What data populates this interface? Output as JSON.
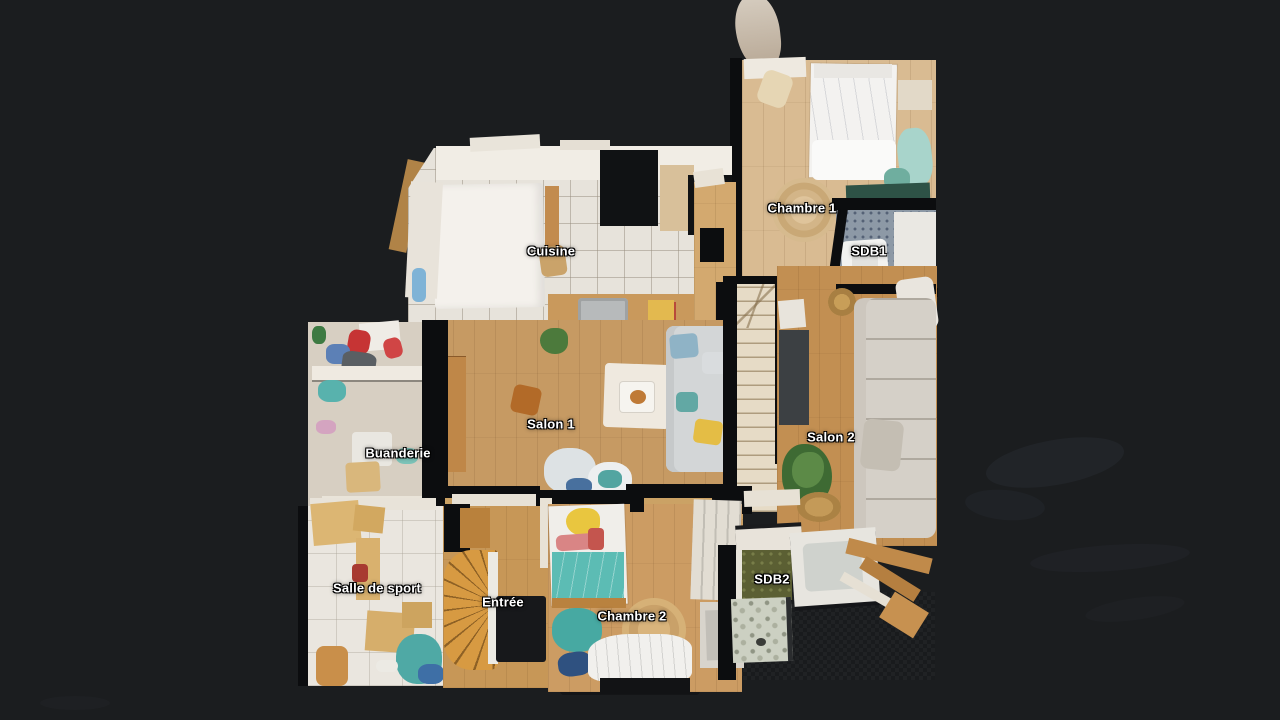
{
  "scene": {
    "type": "floorplan-top-down-scan",
    "description": "3D dollhouse floor plan view of an apartment on a dark viewer background"
  },
  "palette": {
    "bg": "#1b1d1f",
    "wall": "#0c0d0f",
    "label_text": "#ffffff",
    "wood1": "#d9bb92",
    "wood2": "#c69a63",
    "wood3": "#c28f52",
    "wood4": "#c79757",
    "wood5": "#cc9c63",
    "hall_wood": "#cba265",
    "tile_kitchen": "#e7e3db",
    "floor_sport": "#eae6df",
    "floor_buanderie": "#d7cfc2",
    "stairs": "#e6dbc6",
    "stairs_spiral": "#d79a42",
    "tile_sdb1": "#8d99a6",
    "green_sdb2": "#5b5f33",
    "shower": "#ccd0c2"
  },
  "rooms": [
    {
      "id": "cuisine",
      "label": "Cuisine"
    },
    {
      "id": "chambre-1",
      "label": "Chambre 1"
    },
    {
      "id": "sdb1",
      "label": "SDB1"
    },
    {
      "id": "salon-1",
      "label": "Salon 1"
    },
    {
      "id": "salon-2",
      "label": "Salon 2"
    },
    {
      "id": "buanderie",
      "label": "Buanderie"
    },
    {
      "id": "salle-de-sport",
      "label": "Salle de sport"
    },
    {
      "id": "entree",
      "label": "Entrée"
    },
    {
      "id": "chambre-2",
      "label": "Chambre 2"
    },
    {
      "id": "sdb2",
      "label": "SDB2"
    }
  ]
}
